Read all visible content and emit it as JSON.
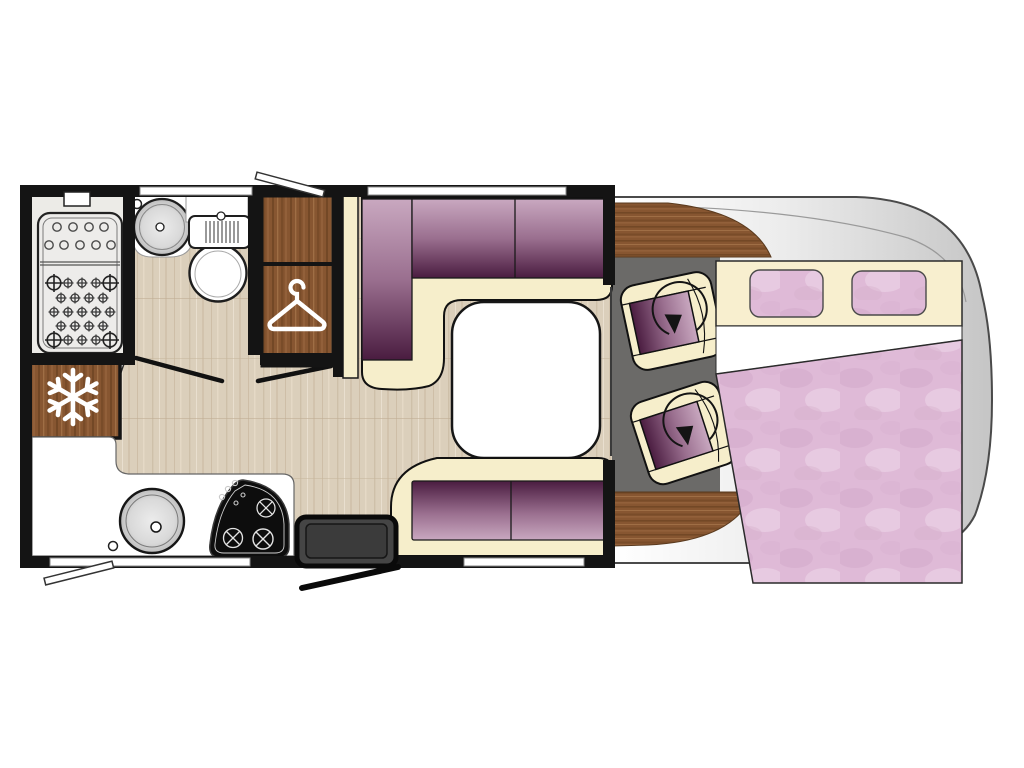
{
  "floorplan": {
    "type": "motorhome-floor-plan",
    "view": "top-down",
    "colors": {
      "wall": "#141414",
      "wood": "#875631",
      "wood_dark": "#6b4121",
      "wood_light": "#a5744a",
      "laminate": "#dbcfbb",
      "cream": "#f6eecb",
      "upholstery_light": "#c9a8c0",
      "upholstery_mid": "#9a6f8f",
      "upholstery_dark": "#4a1c40",
      "bedding_pink": "#dfbad7",
      "cab_floor": "#6b6a68",
      "body_shell": "#c5c5c5",
      "counter_white": "#ffffff",
      "hob_black": "#0d0d0d"
    },
    "rooms": {
      "bathroom": {
        "fixtures": [
          "shower-tray",
          "washbasin",
          "toilet"
        ]
      },
      "wardrobe": {
        "icon": "hanger-icon",
        "sections": 2
      },
      "refrigerator": {
        "icon": "snowflake-icon"
      },
      "kitchen": {
        "fixtures": [
          "round-sink",
          "hob",
          "entry-step"
        ],
        "hob_burners": 3
      },
      "lounge": {
        "furniture": [
          "l-shaped-dinette",
          "side-bench",
          "table"
        ],
        "seat_cushions": 5
      },
      "cab": {
        "furniture": [
          "driver-swivel-seat",
          "passenger-swivel-seat",
          "dashboard"
        ],
        "icon": "swivel-arrow-icon",
        "seats": 2
      },
      "bedroom": {
        "furniture": [
          "double-bed",
          "headboard",
          "duvet"
        ],
        "pillows": 2
      }
    },
    "openings": {
      "windows": 4,
      "window_flaps": 2,
      "interior_door_leaves": 1,
      "door_swing_lines": 2,
      "entry_doors": 1
    }
  }
}
